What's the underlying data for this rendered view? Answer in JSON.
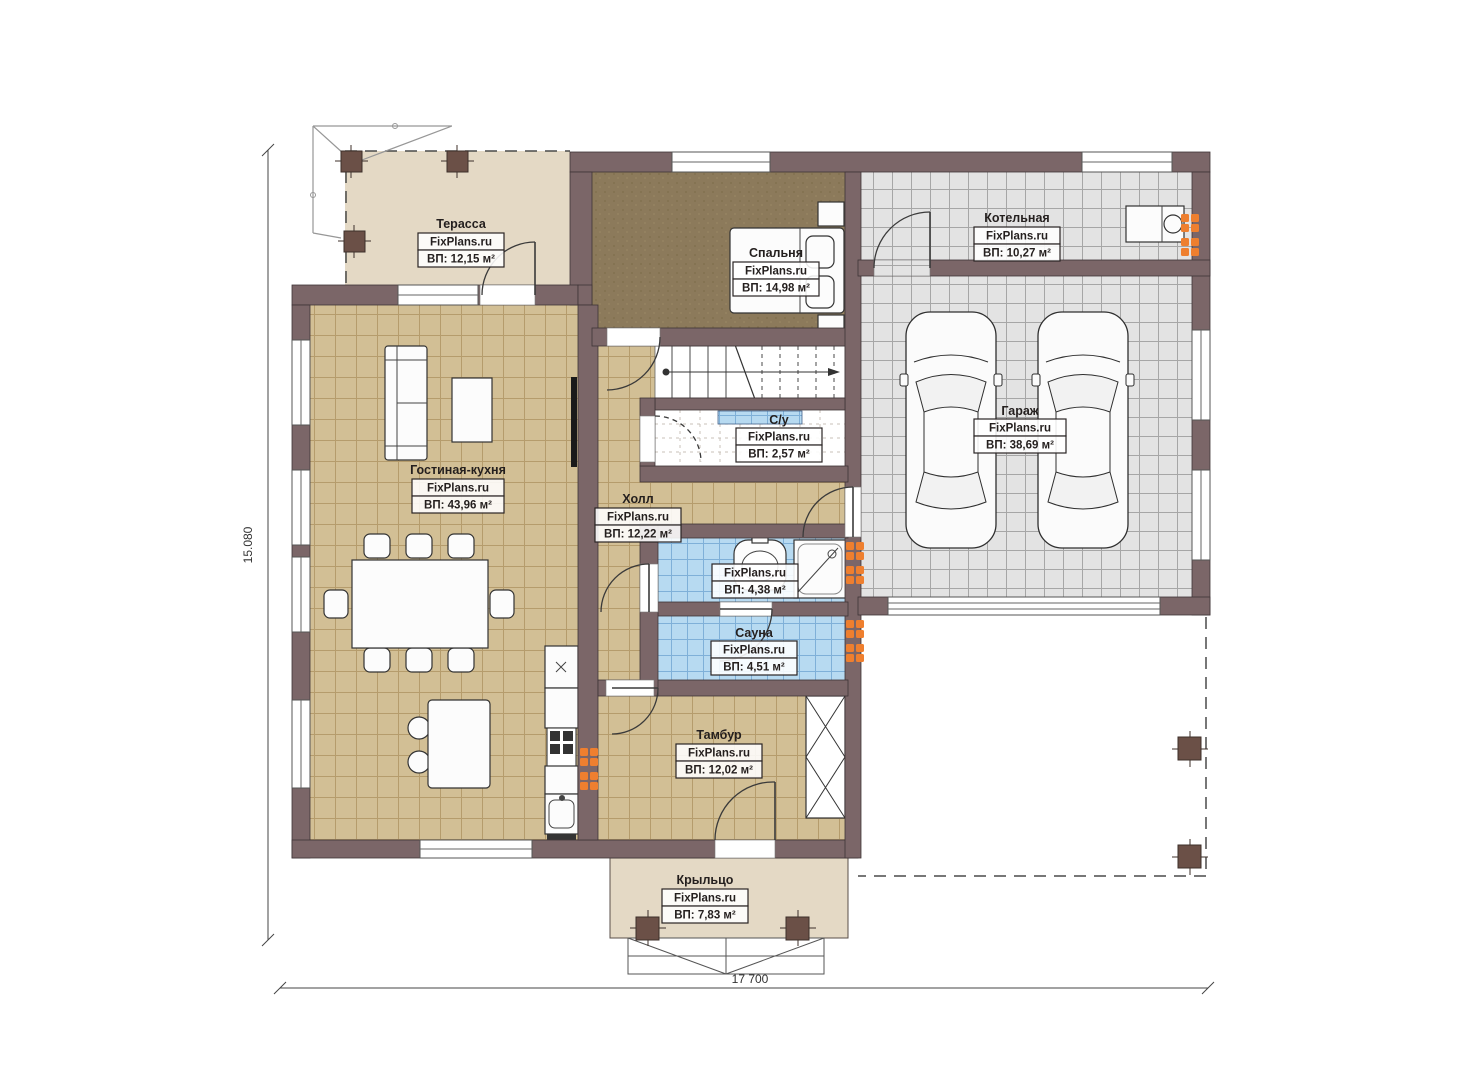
{
  "watermark": "FixPlans.ru",
  "dimensions": {
    "left": "15.080",
    "bottom": "17 700"
  },
  "rooms": [
    {
      "name": "Терасса",
      "area": "ВП: 12,15 м²"
    },
    {
      "name": "Спальня",
      "area": "ВП: 14,98 м²"
    },
    {
      "name": "Котельная",
      "area": "ВП: 10,27 м²"
    },
    {
      "name": "Гостиная-кухня",
      "area": "ВП: 43,96 м²"
    },
    {
      "name": "Холл",
      "area": "ВП: 12,22 м²"
    },
    {
      "name": "С/у",
      "area": "ВП: 2,57 м²"
    },
    {
      "name": "Гараж",
      "area": "ВП: 38,69 м²"
    },
    {
      "name": "",
      "area": "ВП: 4,38 м²"
    },
    {
      "name": "Сауна",
      "area": "ВП: 4,51 м²"
    },
    {
      "name": "Тамбур",
      "area": "ВП: 12,02 м²"
    },
    {
      "name": "Крыльцо",
      "area": "ВП: 7,83 м²"
    }
  ],
  "colors": {
    "wall": "#7b6668",
    "floor_beige": "#d2bf95",
    "floor_gray": "#e3e3e3",
    "floor_blue": "#b7daf1",
    "floor_wood": "#e4d9c5",
    "carpet": "#8c7a5b",
    "radiator": "#ee7f2f"
  }
}
